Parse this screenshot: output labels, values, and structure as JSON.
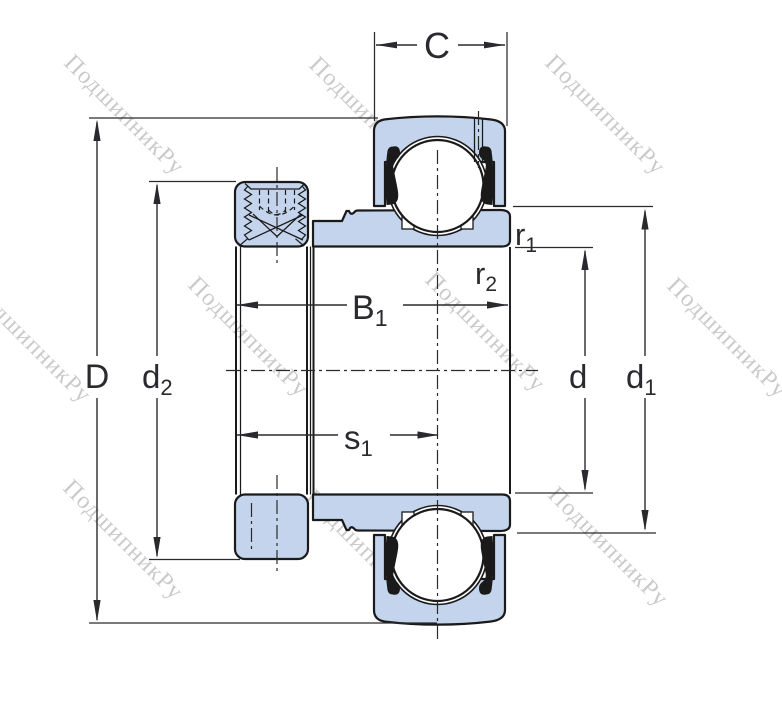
{
  "watermark": {
    "text": "ПодшипникРу"
  },
  "dimensions": {
    "C": {
      "base": "C",
      "sub": ""
    },
    "D": {
      "base": "D",
      "sub": ""
    },
    "d2": {
      "base": "d",
      "sub": "2"
    },
    "B1": {
      "base": "B",
      "sub": "1"
    },
    "s1": {
      "base": "s",
      "sub": "1"
    },
    "r1": {
      "base": "r",
      "sub": "1"
    },
    "r2": {
      "base": "r",
      "sub": "2"
    },
    "d": {
      "base": "d",
      "sub": ""
    },
    "d1": {
      "base": "d",
      "sub": "1"
    }
  },
  "colors": {
    "part_fill": "#c4d4ec",
    "outline": "#1a1a1a",
    "dimension": "#2a2a2e",
    "watermark": "#cacaca",
    "background": "#ffffff"
  }
}
